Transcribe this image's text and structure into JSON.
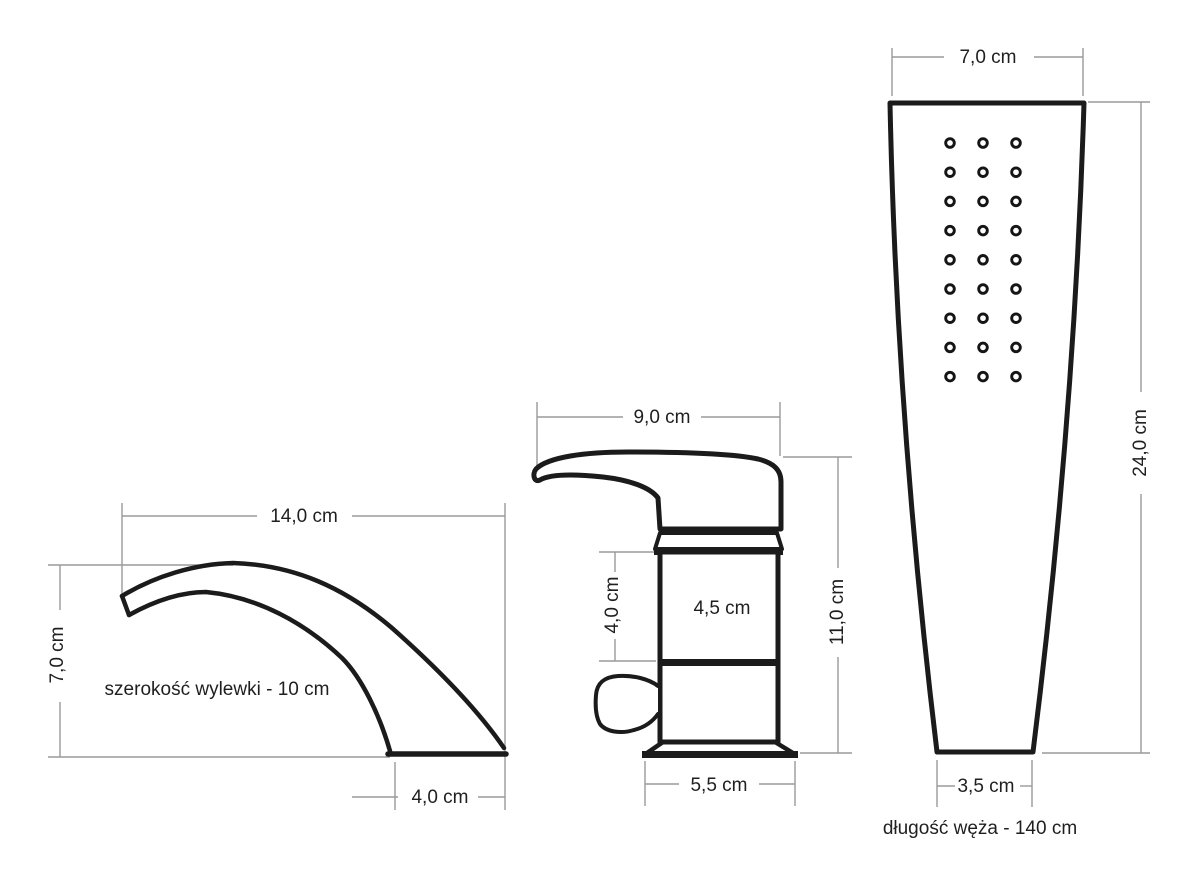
{
  "diagram": {
    "spout": {
      "top_width": "14,0 cm",
      "height": "7,0 cm",
      "outlet_width": "4,0 cm",
      "note": "szerokość wylewki - 10 cm"
    },
    "mixer": {
      "top_width": "9,0 cm",
      "cartridge_height": "4,0 cm",
      "body_width": "4,5 cm",
      "total_height": "11,0 cm",
      "base_width": "5,5 cm"
    },
    "handshower": {
      "top_width": "7,0 cm",
      "height": "24,0 cm",
      "bottom_width": "3,5 cm",
      "note": "długość węża - 140 cm"
    }
  },
  "colors": {
    "background": "#ffffff",
    "outline": "#1b1b1b",
    "dimension_line": "#9a9a9a",
    "label_text": "#1f1f1f"
  },
  "nozzle_grid": {
    "columns": 3,
    "rows": 9
  }
}
